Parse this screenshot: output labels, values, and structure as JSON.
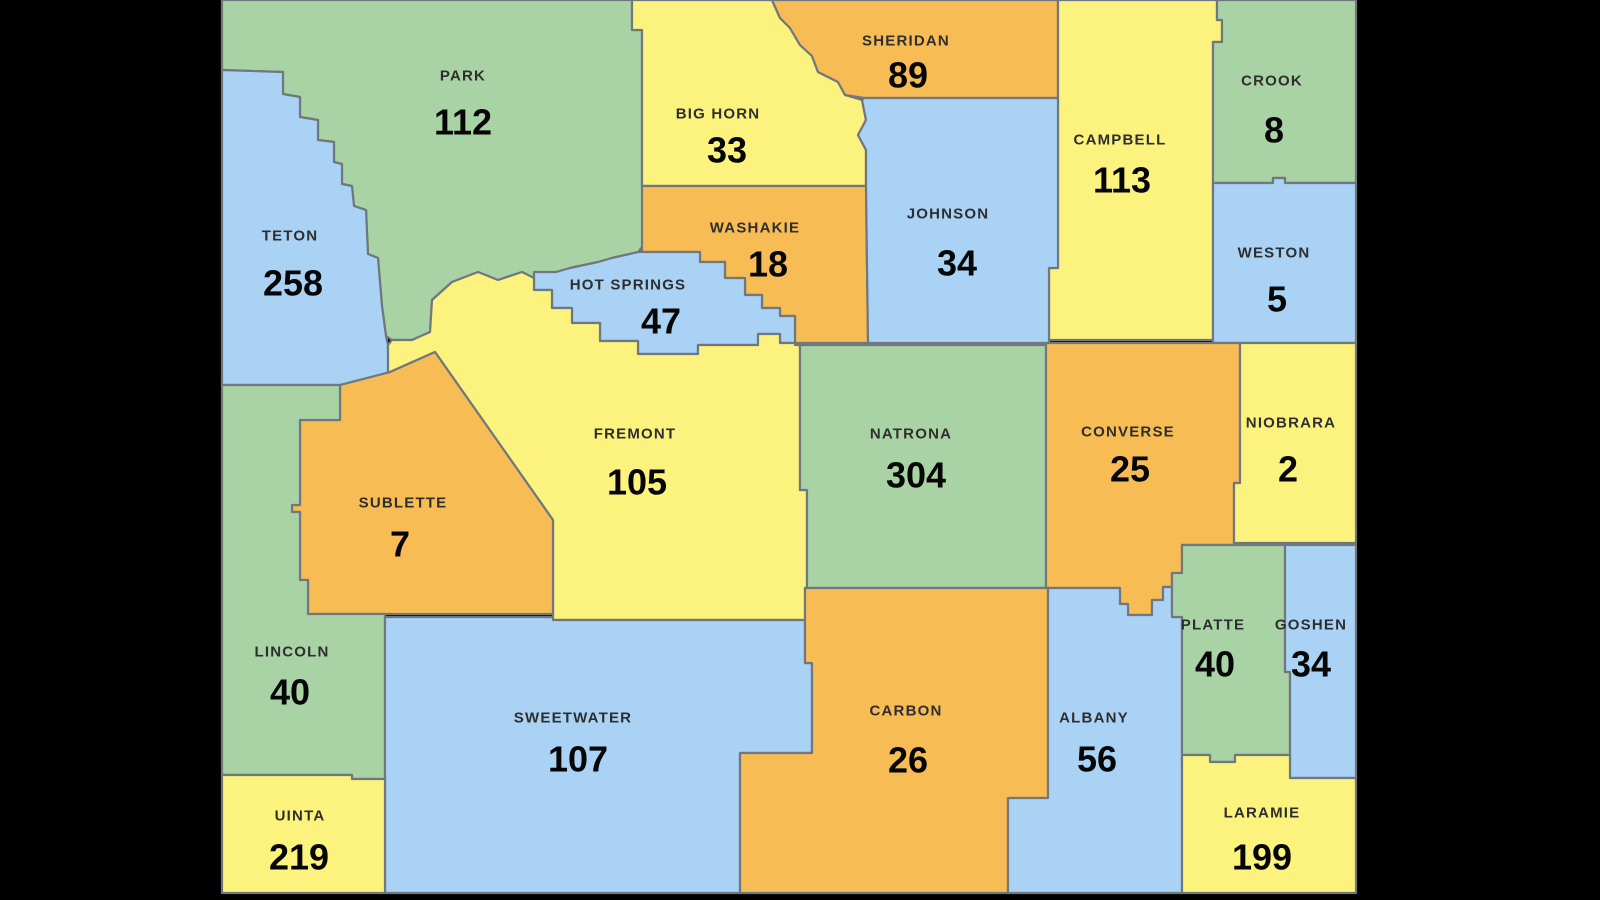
{
  "map": {
    "description": "Wyoming county map with per-county counts",
    "background_color": "#000000",
    "border_color": "#70777e",
    "label_color": "#2e2e2e",
    "value_color": "#060606",
    "palette": {
      "green": "#a9d3a4",
      "yellow": "#fbf37d",
      "orange": "#f8bc55",
      "blue": "#a9d2f4"
    },
    "counties": [
      {
        "name": "PARK",
        "value": "112",
        "color": "#a9d3a4"
      },
      {
        "name": "BIG HORN",
        "value": "33",
        "color": "#fbf37d"
      },
      {
        "name": "SHERIDAN",
        "value": "89",
        "color": "#f8bc55"
      },
      {
        "name": "CAMPBELL",
        "value": "113",
        "color": "#fbf37d"
      },
      {
        "name": "CROOK",
        "value": "8",
        "color": "#a9d3a4"
      },
      {
        "name": "TETON",
        "value": "258",
        "color": "#a9d2f4"
      },
      {
        "name": "WASHAKIE",
        "value": "18",
        "color": "#f8bc55"
      },
      {
        "name": "JOHNSON",
        "value": "34",
        "color": "#a9d2f4"
      },
      {
        "name": "WESTON",
        "value": "5",
        "color": "#a9d2f4"
      },
      {
        "name": "HOT SPRINGS",
        "value": "47",
        "color": "#a9d2f4"
      },
      {
        "name": "FREMONT",
        "value": "105",
        "color": "#fbf37d"
      },
      {
        "name": "NATRONA",
        "value": "304",
        "color": "#a9d3a4"
      },
      {
        "name": "CONVERSE",
        "value": "25",
        "color": "#f8bc55"
      },
      {
        "name": "NIOBRARA",
        "value": "2",
        "color": "#fbf37d"
      },
      {
        "name": "SUBLETTE",
        "value": "7",
        "color": "#f8bc55"
      },
      {
        "name": "LINCOLN",
        "value": "40",
        "color": "#a9d3a4"
      },
      {
        "name": "SWEETWATER",
        "value": "107",
        "color": "#a9d2f4"
      },
      {
        "name": "UINTA",
        "value": "219",
        "color": "#fbf37d"
      },
      {
        "name": "CARBON",
        "value": "26",
        "color": "#f8bc55"
      },
      {
        "name": "ALBANY",
        "value": "56",
        "color": "#a9d2f4"
      },
      {
        "name": "PLATTE",
        "value": "40",
        "color": "#a9d3a4"
      },
      {
        "name": "GOSHEN",
        "value": "34",
        "color": "#a9d2f4"
      },
      {
        "name": "LARAMIE",
        "value": "199",
        "color": "#fbf37d"
      }
    ]
  }
}
